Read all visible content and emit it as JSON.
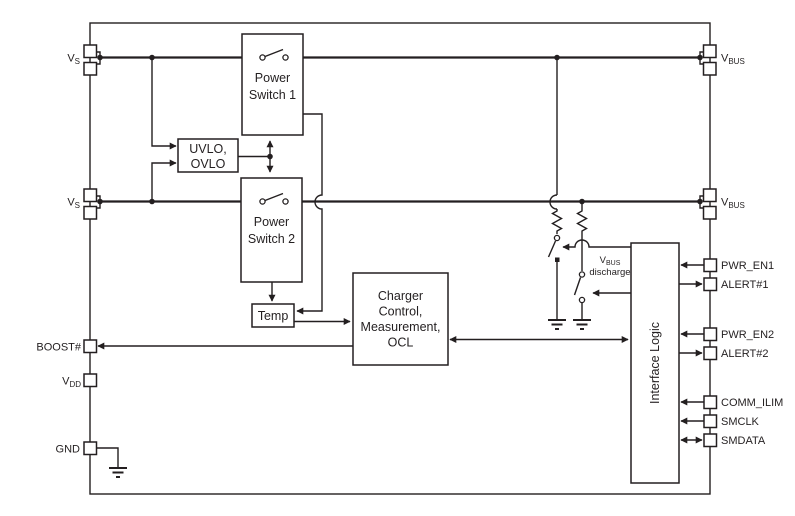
{
  "colors": {
    "line": "#231f20",
    "background": "#ffffff"
  },
  "blocks": {
    "power_switch_1": {
      "line1": "Power",
      "line2": "Switch 1"
    },
    "power_switch_2": {
      "line1": "Power",
      "line2": "Switch 2"
    },
    "uvlo_ovlo": {
      "line1": "UVLO,",
      "line2": "OVLO"
    },
    "temp": {
      "label": "Temp"
    },
    "charger": {
      "line1": "Charger",
      "line2": "Control,",
      "line3": "Measurement,",
      "line4": "OCL"
    },
    "interface_logic": {
      "label": "Interface Logic"
    }
  },
  "pins": {
    "vs1": {
      "base": "V",
      "sub": "S"
    },
    "vs2": {
      "base": "V",
      "sub": "S"
    },
    "boost": {
      "label": "BOOST#"
    },
    "vdd": {
      "base": "V",
      "sub": "DD"
    },
    "gnd": {
      "label": "GND"
    },
    "vbus1": {
      "base": "V",
      "sub": "BUS"
    },
    "vbus2": {
      "base": "V",
      "sub": "BUS"
    },
    "pwr_en1": {
      "label": "PWR_EN1"
    },
    "alert1": {
      "label": "ALERT#1"
    },
    "pwr_en2": {
      "label": "PWR_EN2"
    },
    "alert2": {
      "label": "ALERT#2"
    },
    "comm_ilim": {
      "label": "COMM_ILIM"
    },
    "smclk": {
      "label": "SMCLK"
    },
    "smdata": {
      "label": "SMDATA"
    }
  },
  "annotations": {
    "vbus_discharge": {
      "base": "V",
      "sub": "BUS",
      "line2": "discharge"
    }
  }
}
